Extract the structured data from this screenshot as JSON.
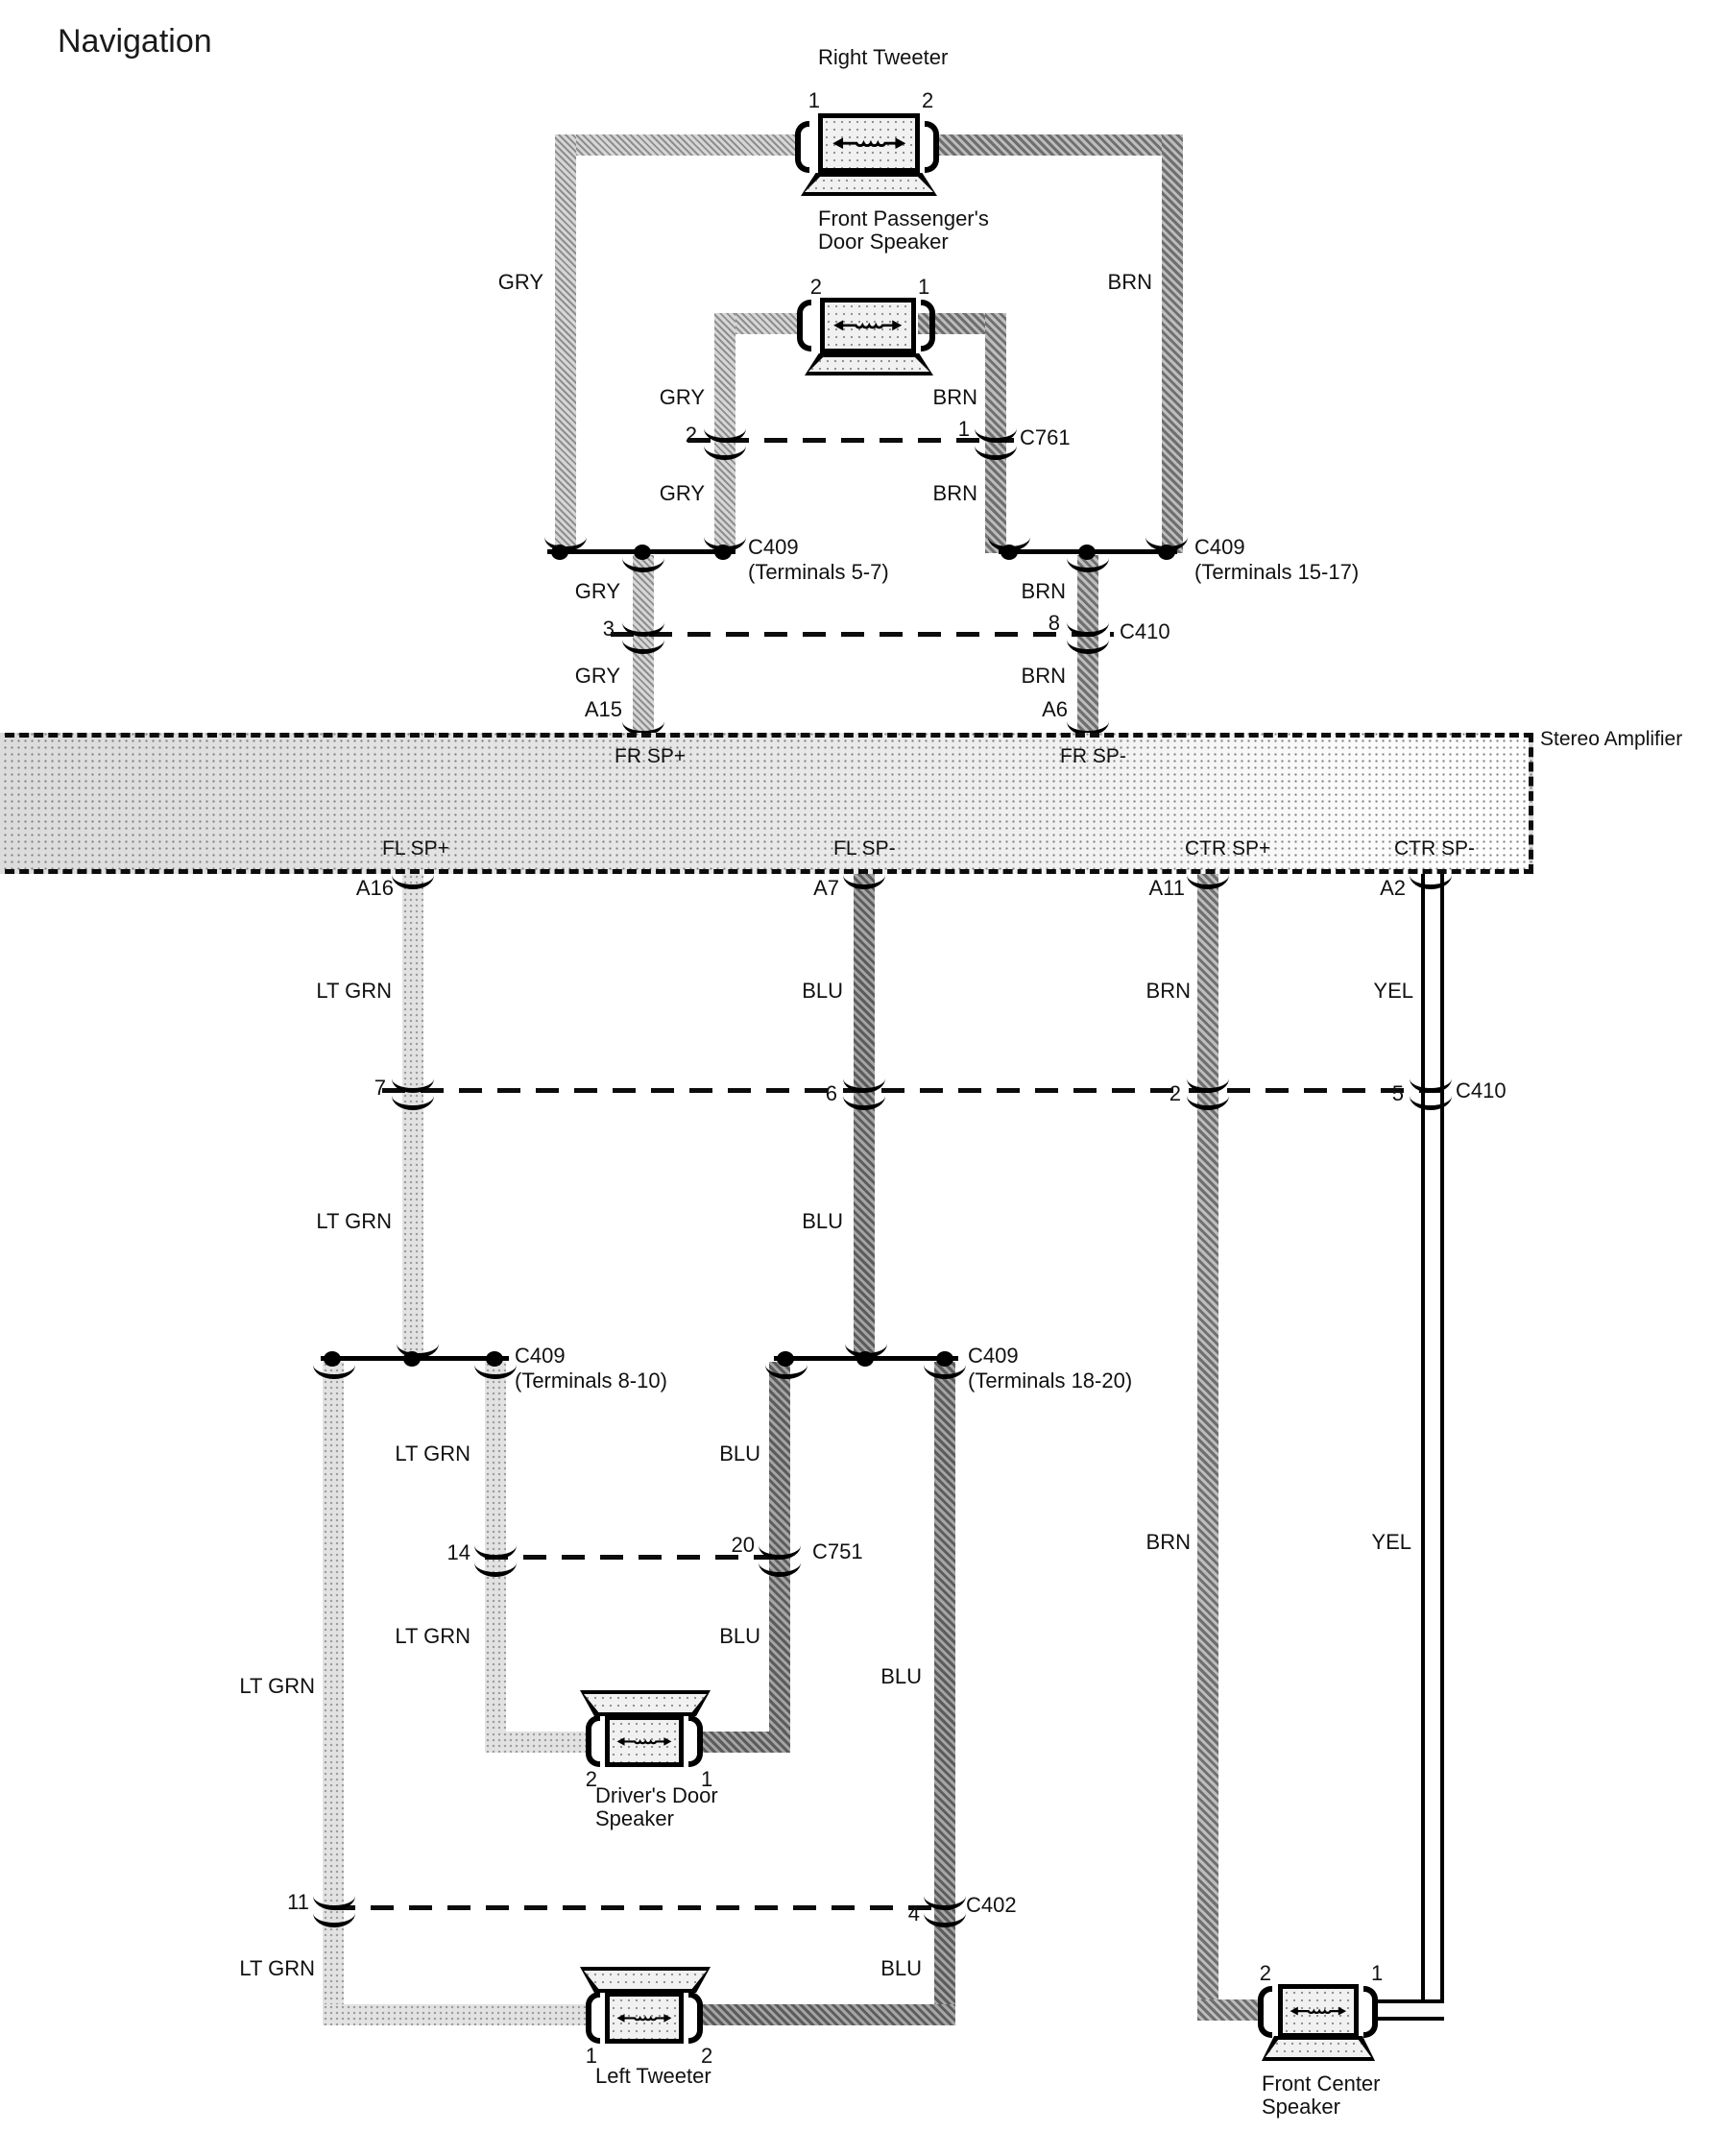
{
  "title": "Navigation",
  "amplifier": {
    "label": "Stereo Amplifier",
    "pins_top": {
      "fr_sp_plus": "FR SP+",
      "fr_sp_minus": "FR SP-"
    },
    "pins_bottom": {
      "fl_sp_plus": "FL SP+",
      "fl_sp_minus": "FL SP-",
      "ctr_sp_plus": "CTR SP+",
      "ctr_sp_minus": "CTR SP-"
    }
  },
  "speakers": {
    "right_tweeter": "Right Tweeter",
    "front_passenger": "Front Passenger's\nDoor Speaker",
    "drivers_door": "Driver's Door\nSpeaker",
    "left_tweeter": "Left Tweeter",
    "front_center": "Front Center\nSpeaker"
  },
  "wire_colors": {
    "gry": "GRY",
    "brn": "BRN",
    "lt_grn": "LT GRN",
    "blu": "BLU",
    "yel": "YEL"
  },
  "connectors": {
    "c761": "C761",
    "c409": "C409",
    "c409_57": "(Terminals 5-7)",
    "c409_1517": "(Terminals 15-17)",
    "c409_810": "(Terminals 8-10)",
    "c409_1820": "(Terminals 18-20)",
    "c410": "C410",
    "c751": "C751",
    "c402": "C402"
  },
  "pins": {
    "p1": "1",
    "p2": "2",
    "p3": "3",
    "p4": "4",
    "p5": "5",
    "p6": "6",
    "p7": "7",
    "p8": "8",
    "p11": "11",
    "p14": "14",
    "p20": "20",
    "a15": "A15",
    "a6": "A6",
    "a16": "A16",
    "a7": "A7",
    "a11": "A11",
    "a2": "A2"
  },
  "colors": {
    "line": "#0c0c0c",
    "background": "#ffffff"
  }
}
